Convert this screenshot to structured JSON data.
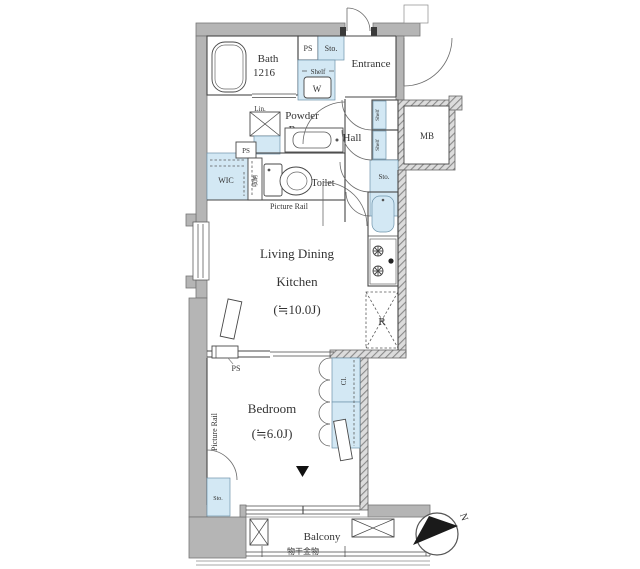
{
  "palette": {
    "background": "#ffffff",
    "wall_gray": "#b5b5b5",
    "wall_outline": "#767676",
    "line_dark": "#474747",
    "fixture_blue": "#d3e8f4",
    "hatch_gray": "#8a8a8a",
    "text_color": "#333333",
    "accent_black": "#1a1a1a"
  },
  "rooms": {
    "bath": {
      "name": "Bath",
      "size": "1216"
    },
    "entrance": {
      "name": "Entrance"
    },
    "powder_room": {
      "line1": "Powder",
      "line2": "Room"
    },
    "hall": {
      "name": "Hall"
    },
    "toilet": {
      "name": "Toilet"
    },
    "wic": {
      "name": "WIC"
    },
    "living_dining_kitchen": {
      "line1": "Living Dining",
      "line2": "Kitchen",
      "area": "(≒10.0J)"
    },
    "bedroom": {
      "name": "Bedroom",
      "area": "(≒6.0J)"
    },
    "balcony": {
      "name": "Balcony"
    }
  },
  "labels": {
    "ps_bath": "PS",
    "ps_wic": "PS",
    "ps_bedroom": "PS",
    "sto_entrance": "Sto.",
    "sto_hall_upper": "Sto.",
    "sto_hall_lower": "Sto.",
    "sto_bedroom": "Sto.",
    "shelf": "Shelf",
    "washer": "W",
    "lin": "Lin.",
    "mb": "MB",
    "shoe_shelf_upper": "Shelf",
    "shoe_shelf_lower": "Shelf",
    "storage_jp": "収納",
    "picture_rail_ldk": "Picture Rail",
    "picture_rail_bedroom": "Picture Rail",
    "refrigerator": "R",
    "closet_upper": "Cl.",
    "closet_lower": "Cl.",
    "laundry_hardware": "物干金物",
    "compass_north": "N"
  }
}
